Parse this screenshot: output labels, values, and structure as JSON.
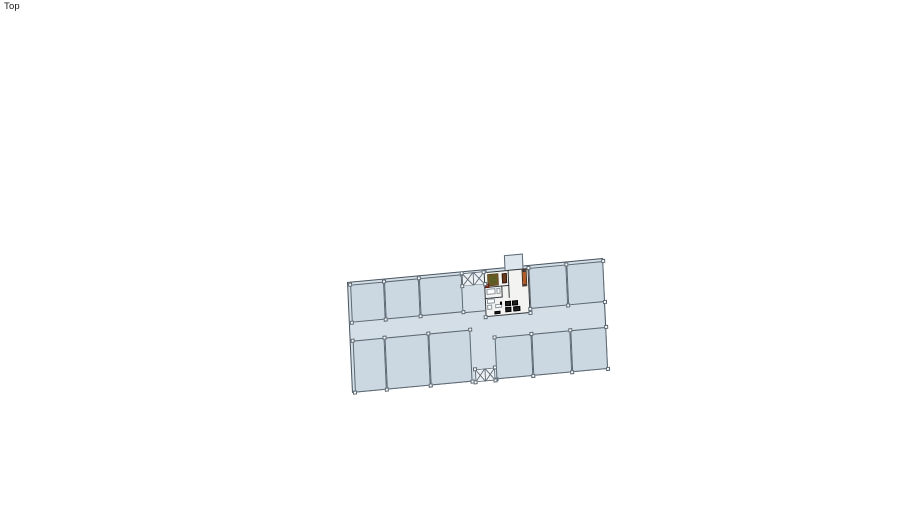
{
  "app": {
    "viewport_label": "Top"
  },
  "colors": {
    "background": "#ffffff",
    "floor": "#d3dee6",
    "room_fill": "#ccd8e1",
    "wall": "#5c6873",
    "outer_wall": "#4a5560",
    "stair_fill": "#eef1f3",
    "unit_floor": "#f3f4f1",
    "unit_wall": "#33383d",
    "balcony_fill": "#dde6ec",
    "column_fill": "#ffffff",
    "table_green": "#5e5e24",
    "frame_brown": "#7d4f26",
    "accent_red": "#a03424",
    "cabinet_brown": "#6b3a1d",
    "bench_orange": "#b35a24",
    "white_fixture": "#fbfcfc",
    "fixture_border": "#8a949c",
    "dark": "#1f1f1f"
  },
  "plan": {
    "building": {
      "x": 347,
      "y": 282,
      "w": 257,
      "h": 111,
      "matrix": [
        0.9963,
        -0.0934,
        0.045,
        0.999,
        0,
        0
      ]
    },
    "rooms": [
      {
        "id": "room-top-1",
        "x": 1.5,
        "y": 1.5,
        "w": 34.5,
        "h": 38.5
      },
      {
        "id": "room-top-2",
        "x": 36,
        "y": 1.5,
        "w": 35,
        "h": 38.5
      },
      {
        "id": "room-top-3",
        "x": 71,
        "y": 1.5,
        "w": 43,
        "h": 38.5
      },
      {
        "id": "room-top-4",
        "x": 181,
        "y": 1.5,
        "w": 38,
        "h": 41.5
      },
      {
        "id": "room-top-5",
        "x": 219,
        "y": 1.5,
        "w": 36.5,
        "h": 41.5
      },
      {
        "id": "room-bottom-1",
        "x": 1.5,
        "y": 58,
        "w": 32.5,
        "h": 51.5
      },
      {
        "id": "room-bottom-2",
        "x": 34,
        "y": 58,
        "w": 44,
        "h": 51.5
      },
      {
        "id": "room-bottom-3",
        "x": 78,
        "y": 58,
        "w": 42,
        "h": 51.5
      },
      {
        "id": "room-bottom-4",
        "x": 144,
        "y": 68,
        "w": 37,
        "h": 41.5
      },
      {
        "id": "room-bottom-5",
        "x": 181,
        "y": 68,
        "w": 39,
        "h": 41.5
      },
      {
        "id": "room-bottom-6",
        "x": 220,
        "y": 68,
        "w": 35.5,
        "h": 41.5
      }
    ],
    "stairwells": [
      {
        "id": "stairwell-north",
        "x": 113.5,
        "y": 0.5,
        "w": 23,
        "h": 13.5,
        "panels": 2
      },
      {
        "id": "stairwell-south",
        "x": 123,
        "y": 97.5,
        "w": 20,
        "h": 13,
        "panels": 2
      }
    ],
    "unit": {
      "x": 136,
      "y": 2,
      "w": 45,
      "h": 45,
      "balcony": {
        "x": 156.5,
        "y": -13,
        "w": 19,
        "h": 15.5
      },
      "walls": [
        {
          "x": 136,
          "y": 17,
          "w": 24.5,
          "h": 1.3
        },
        {
          "x": 136,
          "y": 27.5,
          "w": 17.5,
          "h": 1.2
        },
        {
          "x": 160,
          "y": 2,
          "w": 1.3,
          "h": 28
        },
        {
          "x": 152.5,
          "y": 17,
          "w": 1.2,
          "h": 11
        }
      ]
    },
    "extra_walls": [
      {
        "x": 114,
        "y": 40,
        "w": 22.5,
        "h": 1.1
      }
    ],
    "furniture": [
      {
        "id": "dining-table",
        "type": "table",
        "x": 139.5,
        "y": 5,
        "w": 10.5,
        "h": 10.5
      },
      {
        "id": "red-stool",
        "type": "red",
        "x": 136.5,
        "y": 13.8,
        "w": 4,
        "h": 4
      },
      {
        "id": "cabinet",
        "type": "cabinet",
        "x": 153.5,
        "y": 4.5,
        "w": 5,
        "h": 10
      },
      {
        "id": "bench",
        "type": "bench",
        "x": 174,
        "y": 3,
        "w": 5,
        "h": 17
      },
      {
        "id": "bath-fixture",
        "type": "white",
        "x": 137.5,
        "y": 18.5,
        "w": 9,
        "h": 6.5
      },
      {
        "id": "bath-fixture",
        "type": "white",
        "x": 147.5,
        "y": 18.5,
        "w": 4.5,
        "h": 6.5
      },
      {
        "id": "kitchen-counter",
        "type": "white",
        "x": 137.5,
        "y": 29,
        "w": 8,
        "h": 4.5
      },
      {
        "id": "kitchen-appliance",
        "type": "white",
        "x": 137.5,
        "y": 34.5,
        "w": 5,
        "h": 5
      },
      {
        "id": "kitchen-appliance",
        "type": "white",
        "x": 146,
        "y": 34.5,
        "w": 6.5,
        "h": 4.5
      },
      {
        "id": "stove",
        "type": "dark",
        "x": 150.5,
        "y": 33.2,
        "w": 2.6,
        "h": 2.6
      },
      {
        "id": "armchair",
        "type": "dark",
        "x": 155.5,
        "y": 33,
        "w": 6,
        "h": 5
      },
      {
        "id": "armchair",
        "type": "dark",
        "x": 162.5,
        "y": 32.5,
        "w": 6,
        "h": 5
      },
      {
        "id": "armchair",
        "type": "dark",
        "x": 156,
        "y": 39,
        "w": 6,
        "h": 5
      },
      {
        "id": "sofa",
        "type": "dark",
        "x": 163.5,
        "y": 38.5,
        "w": 7,
        "h": 5.5
      },
      {
        "id": "door-mat",
        "type": "dark",
        "x": 144.5,
        "y": 42,
        "w": 6,
        "h": 3
      }
    ]
  }
}
